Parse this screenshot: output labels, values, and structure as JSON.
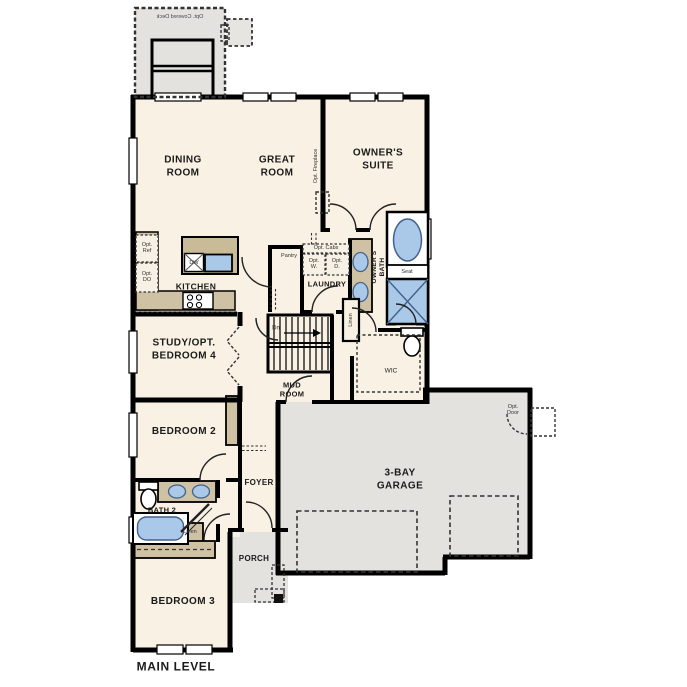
{
  "title": "MAIN LEVEL",
  "colors": {
    "wall": "#000000",
    "floor": "#f8f1e4",
    "garage_porch_deck": "#e3e2df",
    "counter": "#cfc2a4",
    "island": "#c9ba98",
    "fixture_blue": "#aac9e8",
    "dashed_lines": "#333333"
  },
  "labels": {
    "deck": "Opt. Covered Deck",
    "dining_room": "DINING\nROOM",
    "great_room": "GREAT\nROOM",
    "owners_suite": "OWNER'S\nSUITE",
    "opt_fireplace": "Opt. Fireplace",
    "opt_ref": "Opt.\nRef",
    "opt_do": "Opt.\nDO",
    "kitchen": "KITCHEN",
    "dw": "DW",
    "pantry": "Pantry",
    "opt_cabs": "Opt. Cabs",
    "opt_w": "Opt.\nW.",
    "opt_d": "Opt.\nD.",
    "laundry": "LAUNDRY",
    "owners_bath": "OWNER'S\nBATH",
    "seat": "Seat",
    "linen_bath": "Linen",
    "wic": "WIC",
    "dn": "Dn",
    "mud_room": "MUD\nROOM",
    "study": "STUDY/OPT.\nBEDROOM 4",
    "bedroom2": "BEDROOM 2",
    "foyer": "FOYER",
    "bath2": "BATH 2",
    "linen_hall": "Linen",
    "bedroom3": "BEDROOM 3",
    "porch": "PORCH",
    "garage": "3-BAY\nGARAGE",
    "opt_door": "Opt.\nDoor",
    "main_level": "MAIN LEVEL"
  }
}
